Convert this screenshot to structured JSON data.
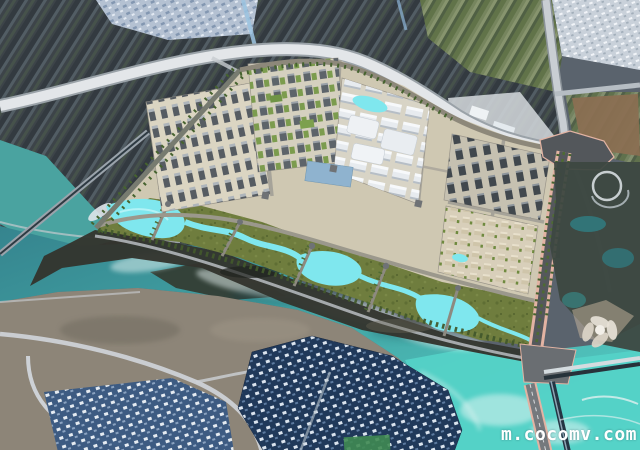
{
  "watermark": {
    "text": "m.cocomv.com",
    "color": "#ffffff"
  },
  "scene": {
    "kind": "aerial-satellite-photo-with-3d-masterplan-render",
    "regions": [
      "north-farmland",
      "northeast-farmland",
      "top-city-strip",
      "northeast-town",
      "main-highway",
      "east-highway",
      "construction-site",
      "planned-district-render",
      "riverside-park-with-streams",
      "south-avenue-bridge",
      "river",
      "river-island",
      "dark-riverbank",
      "southwest-land",
      "dense-residential",
      "weir",
      "flower-structure",
      "ring-structure"
    ]
  },
  "palette": {
    "base": "#5a636d",
    "farm_dark": "#3d4449",
    "farm_green": "#76855e",
    "field_brown": "#8a6f52",
    "city_light": "#b4c1d2",
    "town_white": "#c9d1da",
    "highway": "#e3e6e9",
    "river_deep": "#35848e",
    "river_bright": "#55d3c8",
    "lake_upper": "#4aa3a0",
    "bank_dark": "#33342e",
    "plan_ground": "#cfc8b2",
    "plan_park": "#6f7d3e",
    "stream_cyan": "#7fe7ee",
    "avenue_pink": "#e2b3a3",
    "road_gray": "#85888b",
    "slab_gray": "#565c62",
    "hall_white": "#e9edf1",
    "housing_navy": "#20395a",
    "land_tan": "#8d8578"
  }
}
